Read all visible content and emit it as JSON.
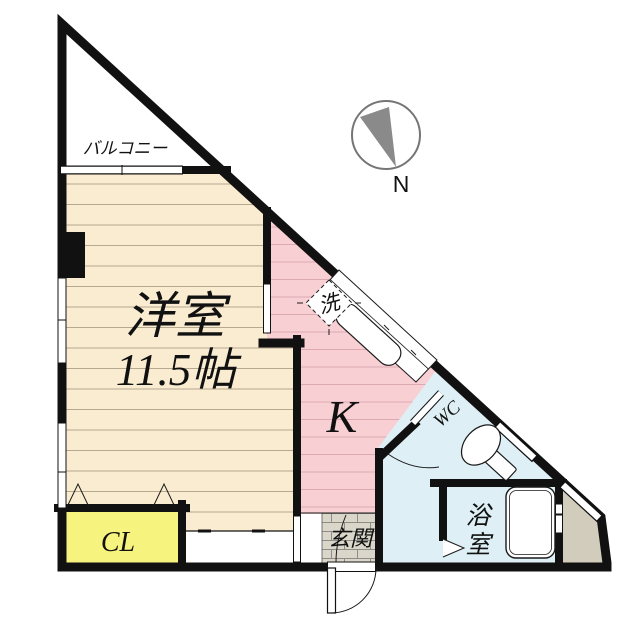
{
  "plan": {
    "type": "apartment floor plan",
    "labels": {
      "balcony": "バルコニー",
      "main_room": "洋室",
      "main_room_size": "11.5帖",
      "kitchen": "K",
      "washer": "洗",
      "toilet": "WC",
      "bath_char1": "浴",
      "bath_char2": "室",
      "closet": "CL",
      "entrance": "玄関",
      "north": "N"
    },
    "colors": {
      "wall": "#111111",
      "thin_line": "#1a1a1a",
      "beige": "#faecd1",
      "beige_stripe": "#b5a98f",
      "pink": "#f8cfd3",
      "pink_stripe": "#dca8b4",
      "blue": "#def0f6",
      "yellow": "#f6f37f",
      "tile": "#dad7ca",
      "tile_line": "#8e8d85",
      "tan": "#d2ccbd",
      "compass_gray": "#757575",
      "needle_gray": "#8a8a8a",
      "white": "#ffffff"
    }
  }
}
